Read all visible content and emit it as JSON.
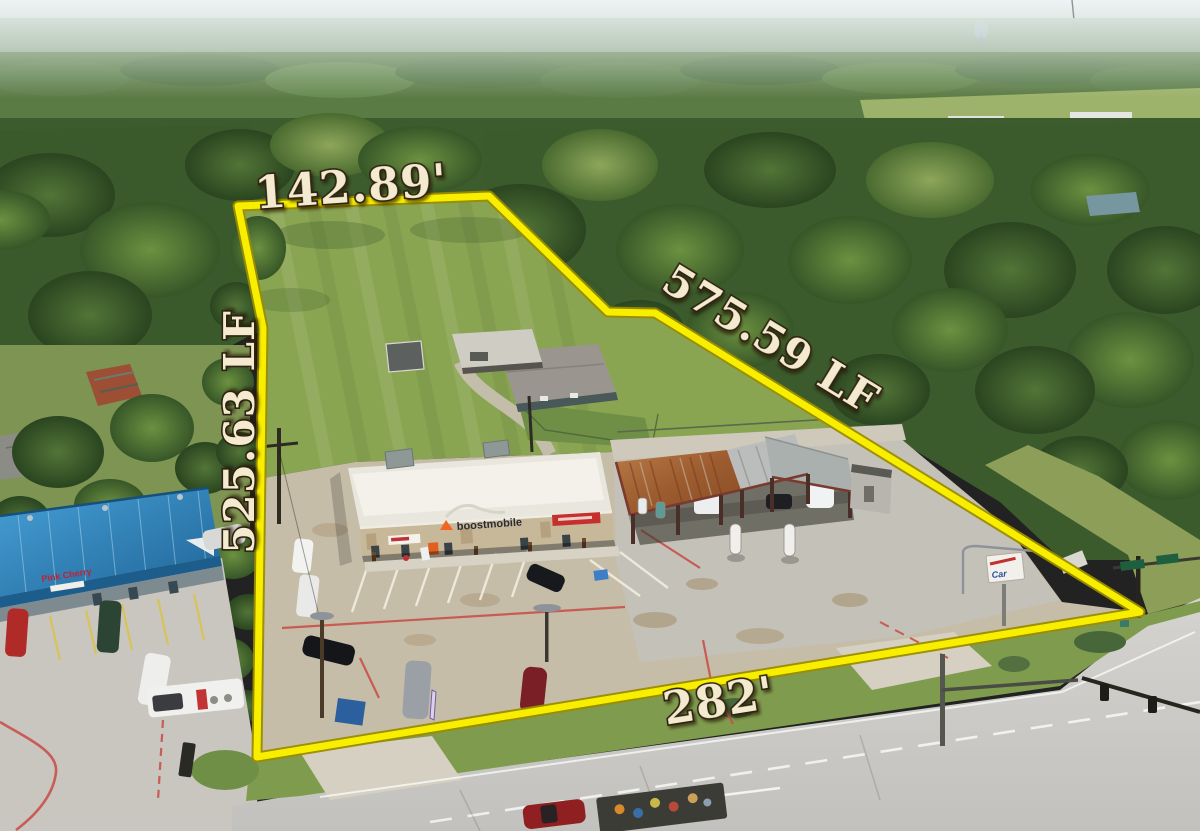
{
  "photo": {
    "kind": "aerial-drone-photo",
    "subject": "commercial property outlined with surveyed boundary"
  },
  "overlay": {
    "boundary": {
      "points": "238,206 489,196 608,312 655,313 1140,612 257,757 263,328",
      "line_color": "#f8ef00",
      "edge_color": "#9c8c00"
    },
    "label_style": {
      "fill": "#f3ead0",
      "outline": "#2e2310"
    },
    "labels": {
      "top_frontage": "142.89'",
      "right_side": "575.59 LF",
      "left_side": "525.63 LF",
      "road_frontage": "282'"
    }
  },
  "scene": {
    "signs": {
      "retail_building": "boostmobile",
      "strip_mall": "Pink Cherry",
      "car_wash_sign": "Car"
    },
    "colors": {
      "forest": "#3c5c2d",
      "field": "#8aa552",
      "pavement": "#c6bda9",
      "road": "#cdccc8",
      "blue_roof": "#2f85c0",
      "rust_roof": "#a05c2f",
      "red_curb": "#c8504a"
    }
  }
}
